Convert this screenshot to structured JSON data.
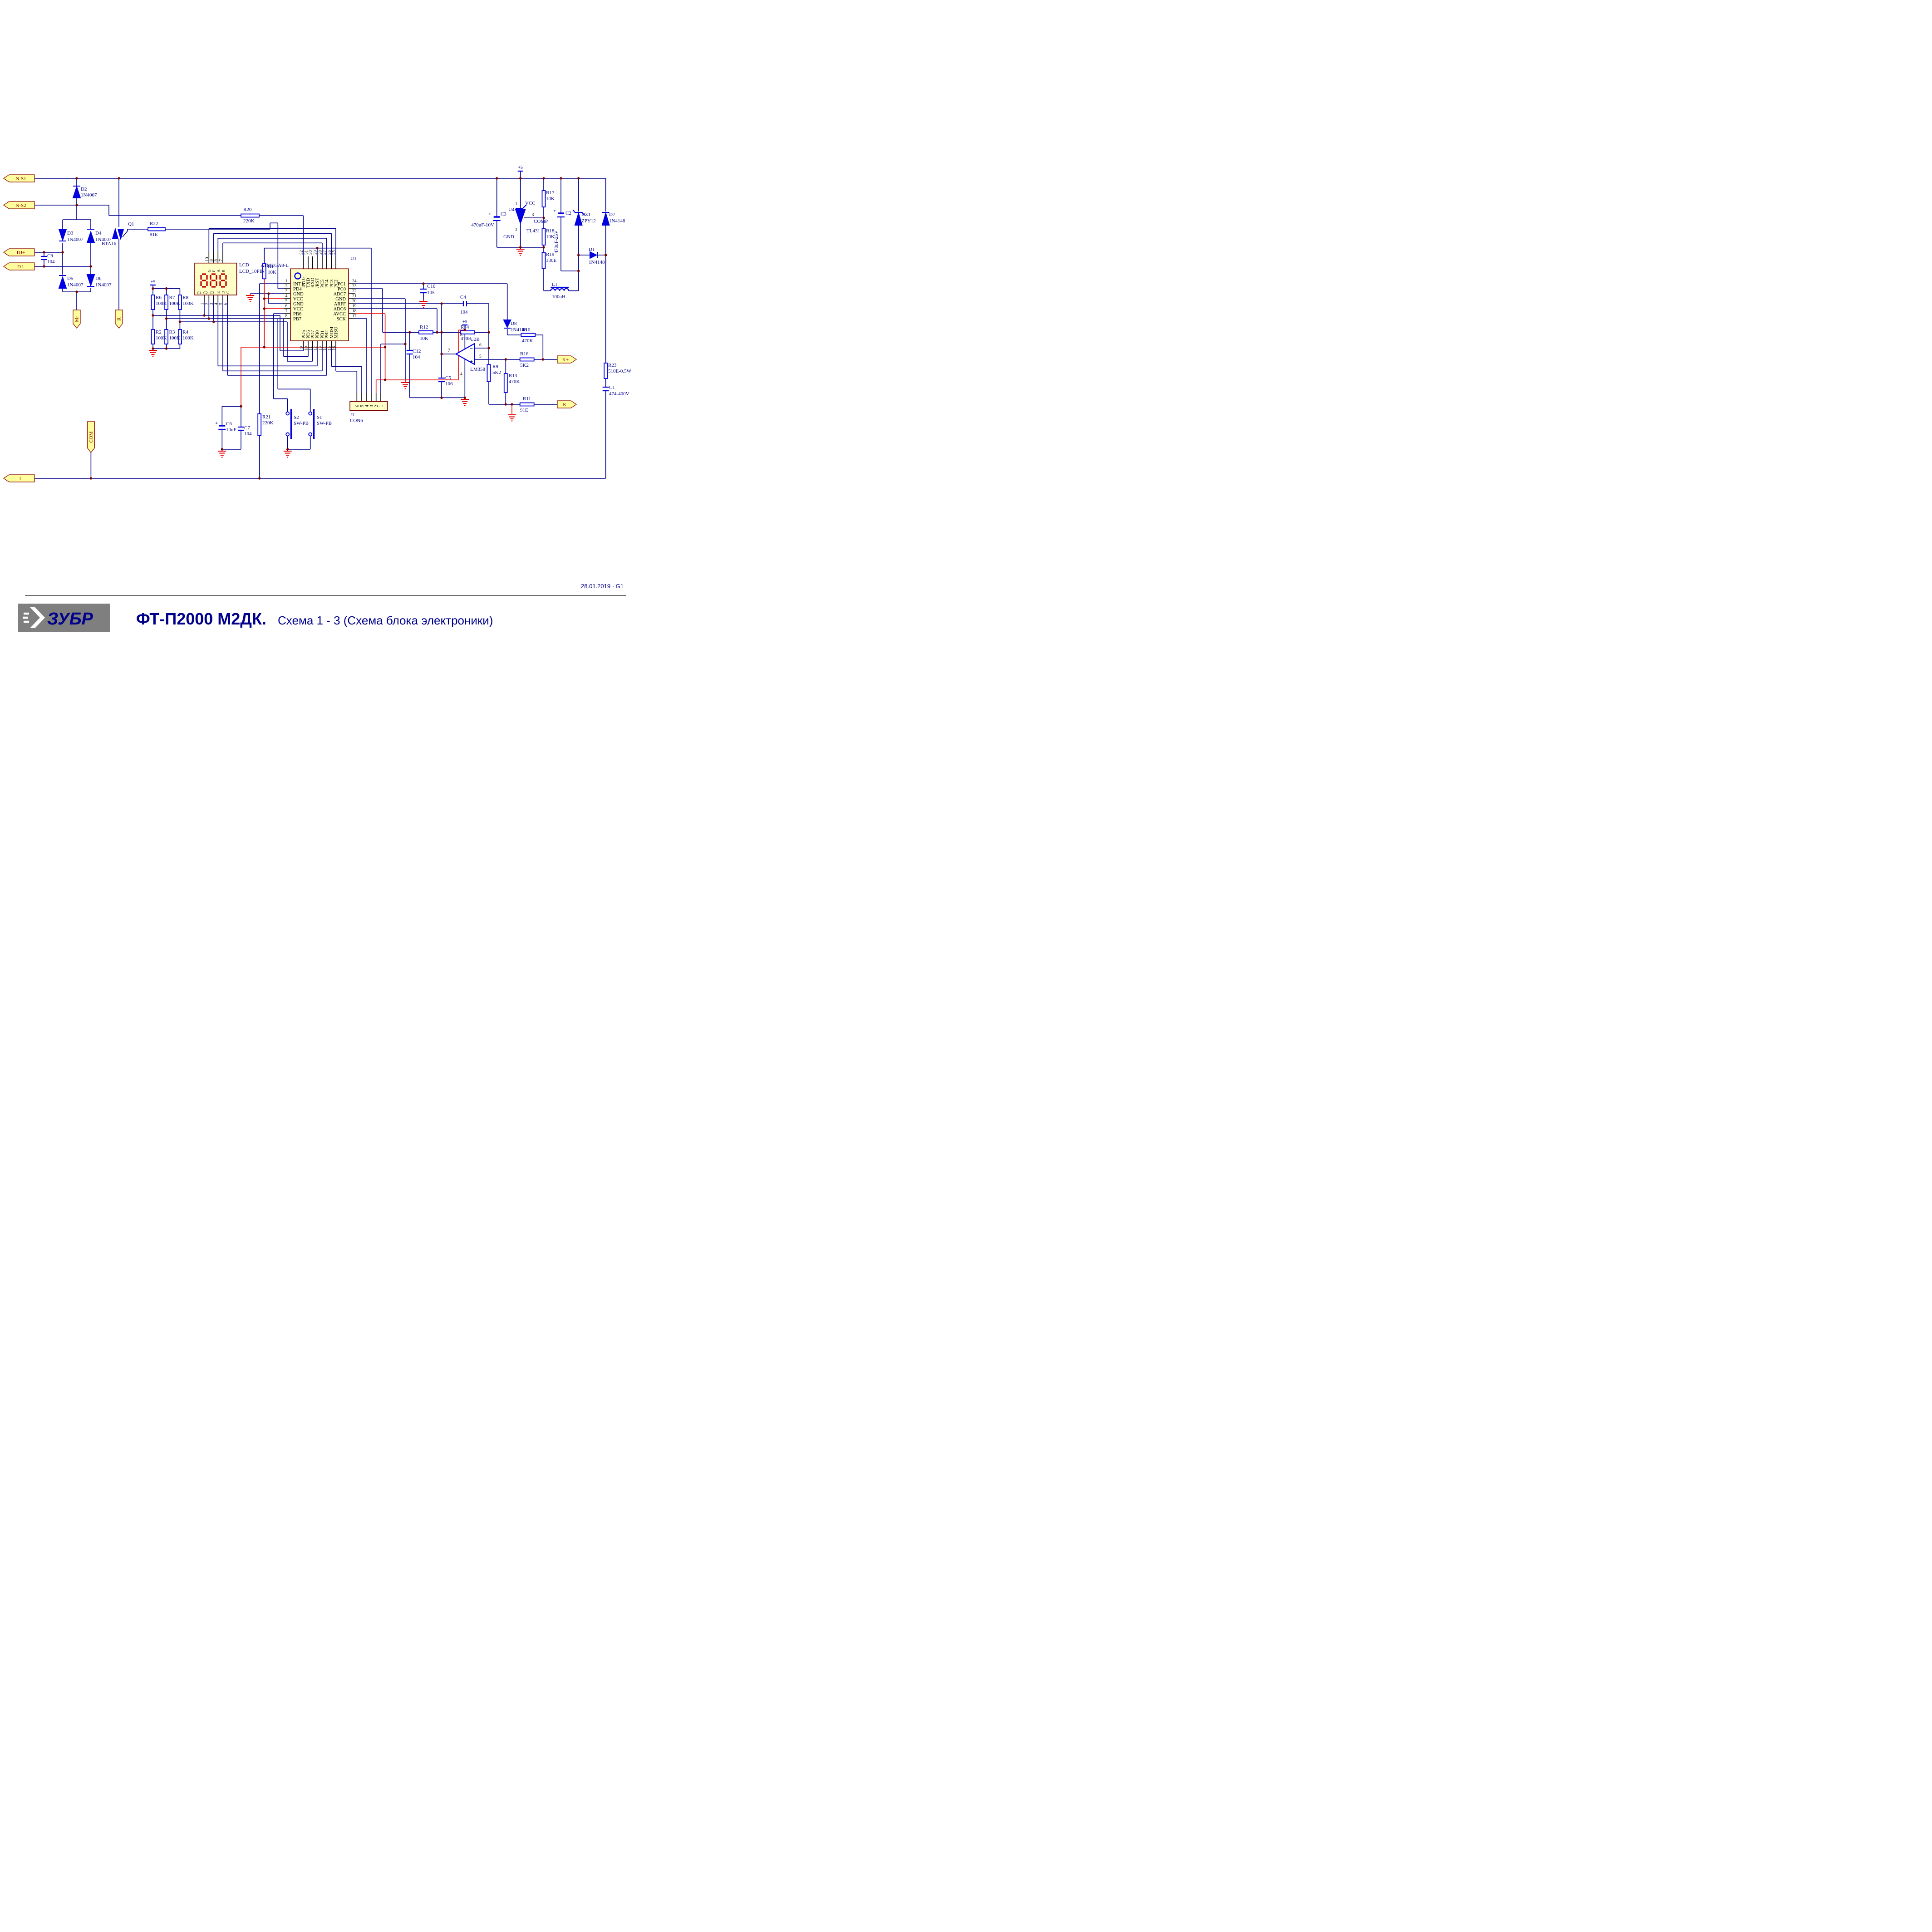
{
  "titleblock": {
    "date": "28.01.2019 · G1",
    "brand": "ЗУБР",
    "model": "ФТ-П2000 М2ДК.",
    "subtitle": "Схема 1 - 3 (Схема блока электроники)"
  },
  "flags": {
    "ns1": "N-S1",
    "ns2": "N-S2",
    "djp": "DJ+",
    "djm": "DJ-",
    "mr": "Mr",
    "r": "R",
    "com": "COM",
    "l": "L",
    "kp": "K+",
    "km": "K-"
  },
  "power": {
    "plus5": "+5",
    "plus": "+"
  },
  "parts": {
    "D2": {
      "r": "D2",
      "v": "1N4007"
    },
    "D3": {
      "r": "D3",
      "v": "1N4007"
    },
    "D4": {
      "r": "D4",
      "v": "1N4007"
    },
    "D5": {
      "r": "D5",
      "v": "1N4007"
    },
    "D6": {
      "r": "D6",
      "v": "1N4007"
    },
    "C9": {
      "r": "C9",
      "v": "104"
    },
    "Q1": {
      "r": "Q1",
      "v": "BTA16"
    },
    "R22": {
      "r": "R22",
      "v": "91E"
    },
    "R20": {
      "r": "R20",
      "v": "220K"
    },
    "R1": {
      "r": "R1",
      "v": "10K"
    },
    "R6": {
      "r": "R6",
      "v": "100K"
    },
    "R7": {
      "r": "R7",
      "v": "100K"
    },
    "R8": {
      "r": "R8",
      "v": "100K"
    },
    "R2": {
      "r": "R2",
      "v": "100K"
    },
    "R3": {
      "r": "R3",
      "v": "100K"
    },
    "R4": {
      "r": "R4",
      "v": "100K"
    },
    "R21": {
      "r": "R21",
      "v": "220K"
    },
    "C6": {
      "r": "C6",
      "v": "10uF"
    },
    "C7": {
      "r": "C7",
      "v": "104"
    },
    "S2": {
      "r": "S2",
      "v": "SW-PB"
    },
    "S1": {
      "r": "S1",
      "v": "SW-PB"
    },
    "C10": {
      "r": "C10",
      "v": "105"
    },
    "C12": {
      "r": "C12",
      "v": "104"
    },
    "R12": {
      "r": "R12",
      "v": "10K"
    },
    "C4": {
      "r": "C4",
      "v": "104"
    },
    "R14": {
      "r": "R14",
      "v": "470K"
    },
    "D8": {
      "r": "D8",
      "v": "1N4148"
    },
    "R10": {
      "r": "R10",
      "v": "470K"
    },
    "C5": {
      "r": "C5",
      "v": "106"
    },
    "R9": {
      "r": "R9",
      "v": "5K2"
    },
    "R13": {
      "r": "R13",
      "v": "470K"
    },
    "R16": {
      "r": "R16",
      "v": "5K2"
    },
    "R11": {
      "r": "R11",
      "v": "91E"
    },
    "R23": {
      "r": "R23",
      "v": "510E-0.5W"
    },
    "C1": {
      "r": "C1",
      "v": "474-400V"
    },
    "C3": {
      "r": "C3",
      "v": "470uF-10V"
    },
    "C2": {
      "r": "C2",
      "v": "470uF-25V"
    },
    "R17": {
      "r": "R17",
      "v": "10K"
    },
    "R18": {
      "r": "R18",
      "v": "10K"
    },
    "R19": {
      "r": "R19",
      "v": "330E"
    },
    "DZ1": {
      "r": "DZ1",
      "v": "ZPY12"
    },
    "D7": {
      "r": "D7",
      "v": "1N4148"
    },
    "D1": {
      "r": "D1",
      "v": "1N4148"
    },
    "L1": {
      "r": "L1",
      "v": "100uH"
    }
  },
  "u4": {
    "r": "U4",
    "part": "TL431",
    "p1": "1",
    "n1": "VCC",
    "p2": "2",
    "n2": "GND",
    "p3": "3",
    "n3": "COMP"
  },
  "u2": {
    "r": "U2B",
    "part": "LM358",
    "p4": "4",
    "p5": "5",
    "p6": "6",
    "p7": "7",
    "p8": "8",
    "minus": "−",
    "plus": "+"
  },
  "j1": {
    "r": "J1",
    "part": "CON6",
    "pins": [
      "6",
      "5",
      "4",
      "3",
      "2",
      "1"
    ]
  },
  "lcd": {
    "r": "LCD",
    "part": "LCD_10PIN",
    "display": "888",
    "tn": [
      "10",
      "9",
      "8",
      "7"
    ],
    "ts": [
      "G",
      "F",
      "A",
      "B"
    ],
    "bn": [
      "1",
      "2",
      "3",
      "4",
      "5",
      "6"
    ],
    "bs": [
      "C1",
      "C2",
      "C3",
      "E",
      "D",
      "C"
    ]
  },
  "u1": {
    "r": "U1",
    "part": "ATMEGA8-L",
    "top": [
      {
        "n": "32",
        "name": "INT0"
      },
      {
        "n": "31",
        "name": "TXD"
      },
      {
        "n": "30",
        "name": "RXD"
      },
      {
        "n": "29",
        "name": "/RST"
      },
      {
        "n": "28",
        "name": "PC5"
      },
      {
        "n": "27",
        "name": "PC4"
      },
      {
        "n": "26",
        "name": "PC3"
      },
      {
        "n": "25",
        "name": "PC2"
      }
    ],
    "left": [
      {
        "n": "1",
        "name": "INT1"
      },
      {
        "n": "2",
        "name": "PD4"
      },
      {
        "n": "3",
        "name": "GND"
      },
      {
        "n": "4",
        "name": "VCC"
      },
      {
        "n": "5",
        "name": "GND"
      },
      {
        "n": "6",
        "name": "VCC"
      },
      {
        "n": "7",
        "name": "PB6"
      },
      {
        "n": "8",
        "name": "PB7"
      }
    ],
    "right": [
      {
        "n": "24",
        "name": "PC1"
      },
      {
        "n": "23",
        "name": "PC0"
      },
      {
        "n": "22",
        "name": "ADC7"
      },
      {
        "n": "21",
        "name": "GND"
      },
      {
        "n": "20",
        "name": "ARFF"
      },
      {
        "n": "19",
        "name": "ADC6"
      },
      {
        "n": "18",
        "name": "AVCC"
      },
      {
        "n": "17",
        "name": "SCK"
      }
    ],
    "bottom": [
      {
        "n": "9",
        "name": "PD5"
      },
      {
        "n": "10",
        "name": "PD6"
      },
      {
        "n": "11",
        "name": "PD7"
      },
      {
        "n": "12",
        "name": "PB0"
      },
      {
        "n": "13",
        "name": "PB1"
      },
      {
        "n": "14",
        "name": "PB2"
      },
      {
        "n": "15",
        "name": "MOSI"
      },
      {
        "n": "16",
        "name": "MISO"
      }
    ]
  }
}
